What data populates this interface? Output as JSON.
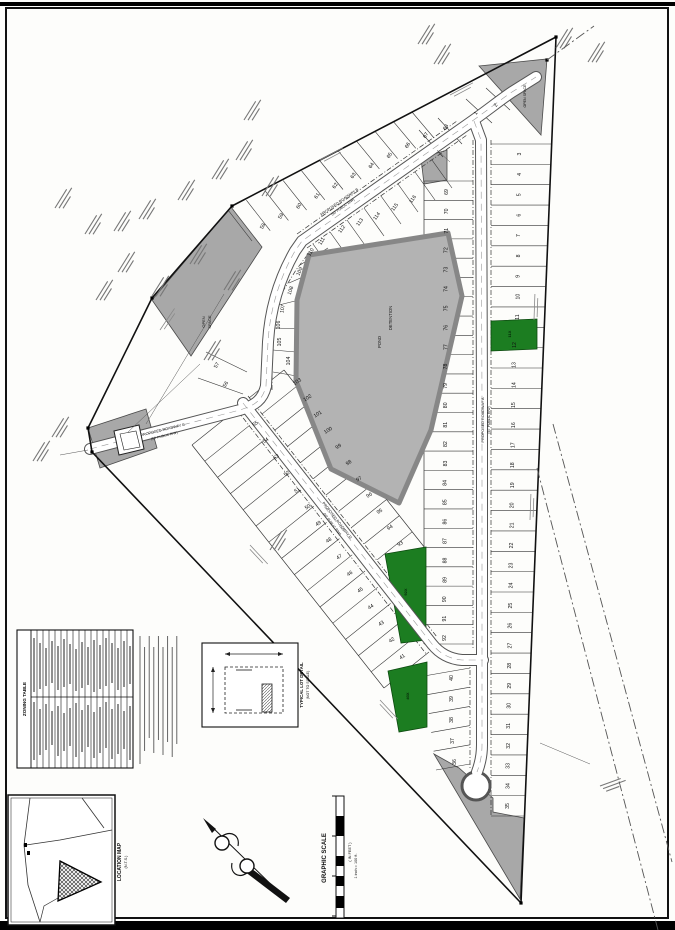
{
  "sheet": {
    "width": 675,
    "height": 930,
    "bg": "#fdfdfb",
    "frame_color": "#111111"
  },
  "colors": {
    "ink": "#1a1a1a",
    "gray_parcel": "#a8a8a8",
    "pond_fill": "#b3b3b3",
    "pond_edge": "#878787",
    "green": "#1c7d21",
    "road_casing": "#555555",
    "road_fill": "#ffffff",
    "squiggle": "#777777",
    "tick": "#333333"
  },
  "captions": {
    "graphic_scale_title": "GRAPHIC SCALE",
    "graphic_scale_sub1": "( IN FEET )",
    "graphic_scale_sub2": "1 inch = 100 ft.",
    "location_map_title": "LOCATION MAP",
    "location_map_sub": "(N.T.S.)",
    "lot_detail_title": "TYPICAL LOT DETAIL",
    "lot_detail_sub": "(NOT TO SCALE)",
    "zoning_table_title": "ZONING TABLE"
  },
  "plat": {
    "boundary": "556,37 521,903 92,452 88,428 152,298 232,206",
    "roads": [
      {
        "label": "PROPOSED ROADWAY B",
        "sub": "(50' PUBLIC R/W)",
        "lx": 340,
        "ly": 203,
        "lrot": -35,
        "d": "M 266 386 L 268 342 C 270 310 279 279 295 251 L 302 241 L 468 124 C 488 110 500 100 512 92 L 536 77"
      },
      {
        "label": "PROPOSED ROADWAY C",
        "sub": "(50' PUBLIC R/W)",
        "lx": 163,
        "ly": 431,
        "lrot": -14,
        "d": "M 90 449 L 236 411 C 256 406 263 399 266 386"
      },
      {
        "label": "PROPOSED ROADWAY A",
        "sub": "(50' PUBLIC R/W)",
        "lx": 484,
        "ly": 420,
        "lrot": -90,
        "d": "M 474 121 L 481 140 L 482 400 L 482 745 C 482 756 480 764 477 772"
      },
      {
        "label": "PROPOSED ROADWAY D",
        "sub": "(50' PUBLIC R/W)",
        "lx": 336,
        "ly": 521,
        "lrot": 52,
        "d": "M 243 403 L 432 644 C 440 654 450 659 462 660 L 483 660"
      }
    ],
    "culdesac": {
      "cx": 476,
      "cy": 786,
      "r": 13
    },
    "pond": {
      "points": "309,255 448,233 462,296 431,430 399,503 331,469 296,381 297,300"
    },
    "map_texts": [
      {
        "t": "DETENTION",
        "x": 392,
        "y": 318,
        "rot": -90,
        "s": 4.2
      },
      {
        "t": "POND",
        "x": 381,
        "y": 342,
        "rot": -90,
        "s": 4.2
      },
      {
        "t": "OPEN",
        "x": 205,
        "y": 322,
        "rot": -90,
        "s": 4
      },
      {
        "t": "SPACE",
        "x": 211,
        "y": 322,
        "rot": -90,
        "s": 4
      },
      {
        "t": "OPEN SPACE",
        "x": 526,
        "y": 96,
        "rot": -90,
        "s": 3.6
      }
    ],
    "green_lots": [
      {
        "label": "11X",
        "points": "491,321 537,319 537,349 491,351",
        "lx": 511,
        "ly": 334
      },
      {
        "label": "92X",
        "points": "385,554 426,547 426,640 401,643",
        "lx": 407,
        "ly": 592
      },
      {
        "label": "40X",
        "points": "388,671 427,662 427,727 399,732",
        "lx": 409,
        "ly": 696
      }
    ],
    "gray_parcels": [
      {
        "points": "479,66 547,59 541,135"
      },
      {
        "points": "152,300 231,207 262,247 191,356"
      },
      {
        "points": "434,754 520,899 524,818 493,812 493,798 459,768"
      },
      {
        "points": "421,158 447,150 447,180 424,184"
      },
      {
        "points": "88,428 146,409 157,448 100,468"
      }
    ],
    "building": {
      "outer": "114,431 139,425 144,449 119,455",
      "inner": "120,434 136,431 140,447 124,450"
    },
    "lot_groups": [
      {
        "nums": [
          3,
          11
        ],
        "from": [
          521,
          154
        ],
        "to": [
          519,
          317
        ],
        "rot": -90
      },
      {
        "nums": [
          12,
          35
        ],
        "from": [
          516,
          345
        ],
        "to": [
          509,
          806
        ],
        "rot": -90
      },
      {
        "nums": [
          69,
          92
        ],
        "from": [
          448,
          192
        ],
        "to": [
          446,
          638
        ],
        "rot": -90
      },
      {
        "nums": [
          58,
          67
        ],
        "from": [
          264,
          227
        ],
        "to": [
          427,
          136
        ],
        "rot": -58
      },
      {
        "nums": [
          41,
          55
        ],
        "from": [
          403,
          658
        ],
        "to": [
          256,
          425
        ],
        "rot": -33
      },
      {
        "nums": [
          93,
          103
        ],
        "from": [
          401,
          545
        ],
        "to": [
          298,
          383
        ],
        "rot": -33
      },
      {
        "points": [
          [
            477,
            114
          ],
          [
            497,
            106
          ]
        ],
        "start": 1,
        "rot": -58
      },
      {
        "points": [
          [
            456,
            762
          ],
          [
            454,
            741
          ],
          [
            453,
            720
          ],
          [
            453,
            699
          ],
          [
            453,
            678
          ]
        ],
        "start": 36,
        "rot": -90
      },
      {
        "points": [
          [
            227,
            385
          ],
          [
            218,
            366
          ]
        ],
        "start": 56,
        "rot": -60
      },
      {
        "points": [
          [
            447,
            128
          ]
        ],
        "start": 68,
        "rot": -58
      },
      {
        "points": [
          [
            290,
            361
          ],
          [
            281,
            342
          ],
          [
            280,
            325
          ],
          [
            284,
            309
          ],
          [
            292,
            291
          ],
          [
            301,
            272
          ],
          [
            312,
            253
          ],
          [
            323,
            242
          ],
          [
            343,
            230
          ],
          [
            361,
            223
          ],
          [
            378,
            217
          ],
          [
            396,
            208
          ],
          [
            414,
            200
          ]
        ],
        "start": 104,
        "rot": -55,
        "rots": [
          -90,
          -90,
          -90,
          -80,
          -72,
          -66,
          -60,
          -58,
          -55,
          -55,
          -55,
          -55,
          -55
        ]
      }
    ],
    "tick_groups": [
      {
        "a1": [
          491,
          144
        ],
        "a2": [
          491,
          816
        ],
        "b1": [
          551,
          144
        ],
        "b2": [
          524,
          816
        ],
        "n": 34
      },
      {
        "a1": [
          473,
          181
        ],
        "a2": [
          473,
          644
        ],
        "b1": [
          424,
          181
        ],
        "b2": [
          424,
          644
        ],
        "n": 25
      },
      {
        "a1": [
          252,
          241
        ],
        "a2": [
          434,
          138
        ],
        "b1": [
          228,
          210
        ],
        "b2": [
          412,
          112
        ],
        "n": 11
      },
      {
        "a1": [
          237,
          409
        ],
        "a2": [
          429,
          652
        ],
        "b1": [
          192,
          445
        ],
        "b2": [
          384,
          688
        ],
        "n": 16
      },
      {
        "a1": [
          249,
          398
        ],
        "a2": [
          390,
          576
        ],
        "b1": [
          284,
          370
        ],
        "b2": [
          425,
          548
        ],
        "n": 12
      },
      {
        "a1": [
          470,
          668
        ],
        "a2": [
          470,
          764
        ],
        "b1": [
          424,
          676
        ],
        "b2": [
          436,
          770
        ],
        "n": 6
      }
    ],
    "tick_segments": [
      [
        273,
        372,
        309,
        378
      ],
      [
        273,
        350,
        307,
        353
      ],
      [
        274,
        328,
        306,
        329
      ],
      [
        279,
        305,
        311,
        297
      ],
      [
        289,
        283,
        319,
        270
      ],
      [
        300,
        265,
        328,
        248
      ],
      [
        313,
        244,
        333,
        272
      ],
      [
        330,
        232,
        350,
        260
      ],
      [
        347,
        220,
        367,
        248
      ],
      [
        364,
        208,
        384,
        236
      ],
      [
        381,
        196,
        401,
        224
      ],
      [
        398,
        184,
        418,
        212
      ],
      [
        415,
        172,
        435,
        200
      ],
      [
        432,
        160,
        452,
        188
      ],
      [
        466,
        99,
        492,
        123
      ],
      [
        486,
        88,
        510,
        110
      ],
      [
        438,
        118,
        462,
        144
      ],
      [
        419,
        130,
        443,
        157
      ],
      [
        206,
        352,
        247,
        372
      ],
      [
        198,
        378,
        243,
        394
      ]
    ],
    "front_lines": [
      [
        491,
        140,
        491,
        816
      ],
      [
        473,
        140,
        473,
        648
      ],
      [
        297,
        234,
        457,
        121
      ],
      [
        307,
        248,
        467,
        135
      ],
      [
        248,
        396,
        437,
        637
      ],
      [
        237,
        410,
        427,
        655
      ],
      [
        470,
        660,
        470,
        770
      ]
    ],
    "front_polylines": [
      "272,390 272,320 280,296 296,270 308,254"
    ],
    "rear_lines": [
      [
        424,
        181,
        424,
        644
      ],
      [
        284,
        370,
        425,
        548
      ],
      [
        192,
        445,
        384,
        688
      ]
    ],
    "owner_marks": [
      [
        244,
        120
      ],
      [
        236,
        160
      ],
      [
        212,
        179
      ],
      [
        178,
        200
      ],
      [
        139,
        219
      ],
      [
        114,
        231
      ],
      [
        85,
        234
      ],
      [
        262,
        196
      ],
      [
        118,
        272
      ],
      [
        152,
        296
      ],
      [
        190,
        264
      ],
      [
        96,
        300
      ],
      [
        55,
        208
      ],
      [
        270,
        550
      ],
      [
        52,
        437
      ],
      [
        33,
        461
      ],
      [
        418,
        44
      ],
      [
        434,
        64
      ],
      [
        556,
        48
      ],
      [
        588,
        62
      ],
      [
        204,
        360
      ],
      [
        224,
        290
      ],
      [
        600,
        786,
        -20
      ]
    ],
    "bearing_marks": [
      [
        320,
        160,
        -28
      ],
      [
        450,
        95,
        -28
      ],
      [
        250,
        545,
        47
      ],
      [
        380,
        700,
        47
      ],
      [
        534,
        320,
        -88
      ],
      [
        530,
        520,
        -88
      ],
      [
        160,
        330,
        -56
      ]
    ],
    "leaders": [
      [
        128,
        432,
        200,
        364
      ],
      [
        146,
        424,
        224,
        294
      ],
      [
        60,
        455,
        88,
        450
      ],
      [
        540,
        743,
        590,
        764
      ],
      [
        437,
        150,
        450,
        162
      ]
    ],
    "existing_road_lines": [
      [
        553,
        424,
        672,
        862
      ],
      [
        537,
        468,
        658,
        930
      ],
      [
        547,
        60,
        594,
        26
      ]
    ],
    "corner_dots": [
      [
        556,
        37
      ],
      [
        521,
        903
      ],
      [
        92,
        452
      ],
      [
        88,
        428
      ],
      [
        152,
        298
      ],
      [
        232,
        206
      ],
      [
        547,
        60
      ]
    ]
  },
  "legend": {
    "zoning_table": {
      "rows": 17,
      "x": 17,
      "y": 630,
      "w": 116,
      "h": 138
    },
    "scale_bar": {
      "x": 336,
      "y": 796,
      "w": 8,
      "h": 122
    }
  }
}
